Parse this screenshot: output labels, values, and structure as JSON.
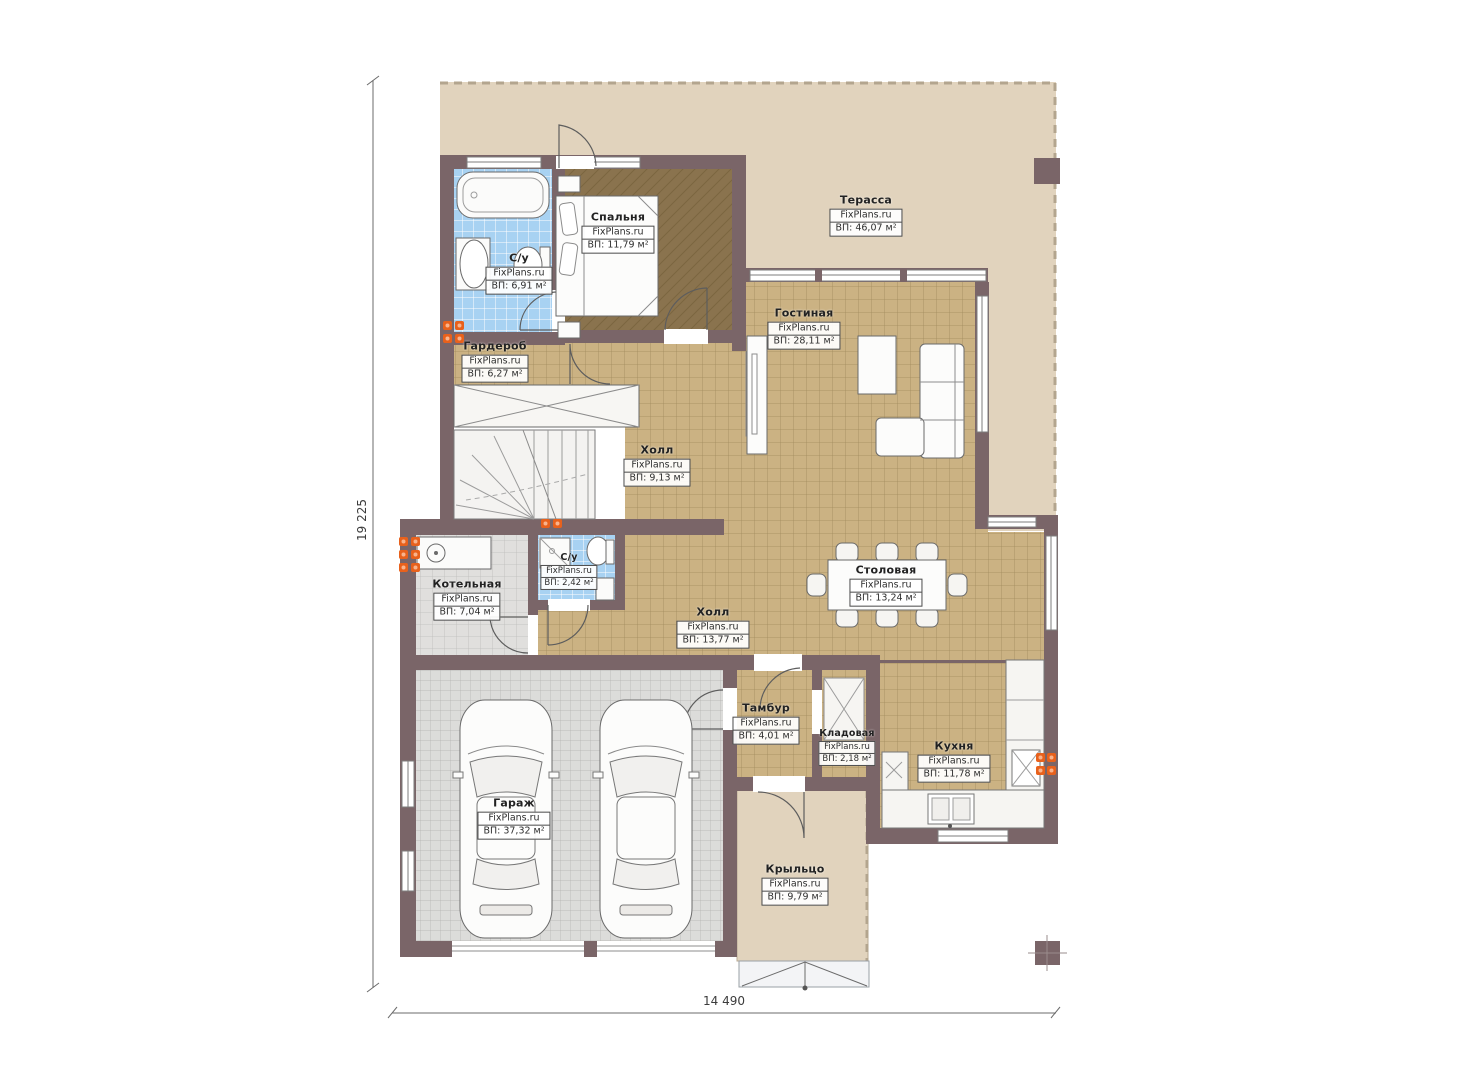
{
  "watermark": "FixPlans.ru",
  "dimensions": {
    "height_label": "19 225",
    "width_label": "14 490"
  },
  "rooms": [
    {
      "id": "terrace",
      "name": "Терасса",
      "area": "ВП: 46,07 м²"
    },
    {
      "id": "bedroom",
      "name": "Спальня",
      "area": "ВП: 11,79 м²"
    },
    {
      "id": "bathroom-1",
      "name": "С/у",
      "area": "ВП: 6,91 м²"
    },
    {
      "id": "wardrobe",
      "name": "Гардероб",
      "area": "ВП: 6,27 м²"
    },
    {
      "id": "living-room",
      "name": "Гостиная",
      "area": "ВП: 28,11 м²"
    },
    {
      "id": "hall-upper",
      "name": "Холл",
      "area": "ВП: 9,13 м²"
    },
    {
      "id": "bathroom-2",
      "name": "С/у",
      "area": "ВП: 2,42 м²"
    },
    {
      "id": "boiler-room",
      "name": "Котельная",
      "area": "ВП: 7,04 м²"
    },
    {
      "id": "dining-room",
      "name": "Столовая",
      "area": "ВП: 13,24 м²"
    },
    {
      "id": "hall-lower",
      "name": "Холл",
      "area": "ВП: 13,77 м²"
    },
    {
      "id": "vestibule",
      "name": "Тамбур",
      "area": "ВП: 4,01 м²"
    },
    {
      "id": "pantry",
      "name": "Кладовая",
      "area": "ВП: 2,18 м²"
    },
    {
      "id": "kitchen",
      "name": "Кухня",
      "area": "ВП: 11,78 м²"
    },
    {
      "id": "garage",
      "name": "Гараж",
      "area": "ВП: 37,32 м²"
    },
    {
      "id": "porch",
      "name": "Крыльцо",
      "area": "ВП: 9,79 м²"
    }
  ],
  "colors": {
    "wall": "#7a6568",
    "floor_tile_tan": "#cbb283",
    "floor_bedroom": "#8a734e",
    "tile_blue": "#a8d2f2",
    "tile_gray": "#e0dfdd",
    "terrace_beige": "#e1d3bd",
    "radiator_orange": "#e8611c"
  }
}
